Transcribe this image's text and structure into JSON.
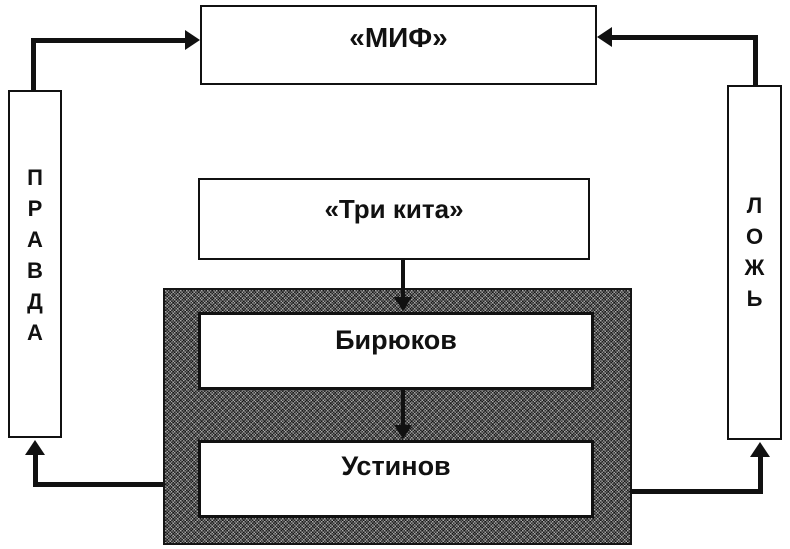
{
  "diagram": {
    "myth": {
      "label": "«МИФ»"
    },
    "three_whales": {
      "label": "«Три кита»"
    },
    "biryukov": {
      "label": "Бирюков"
    },
    "ustinov": {
      "label": "Устинов"
    },
    "truth": {
      "word": "ПРАВДА",
      "letters": [
        "П",
        "Р",
        "А",
        "В",
        "Д",
        "А"
      ]
    },
    "lie": {
      "word": "ЛОЖЬ",
      "letters": [
        "Л",
        "О",
        "Ж",
        "Ь"
      ]
    },
    "connections": [
      {
        "from": "truth",
        "to": "myth",
        "direction": "up-right"
      },
      {
        "from": "lie",
        "to": "myth",
        "direction": "up-left"
      },
      {
        "from": "three_whales",
        "to": "biryukov",
        "direction": "down"
      },
      {
        "from": "biryukov",
        "to": "ustinov",
        "direction": "down"
      },
      {
        "from": "gray-panel-left",
        "to": "truth",
        "direction": "left-up"
      },
      {
        "from": "gray-panel-right",
        "to": "lie",
        "direction": "right-up"
      }
    ]
  },
  "colors": {
    "background": "#ffffff",
    "line": "#111111",
    "box_border": "#111111",
    "box_fill": "#ffffff",
    "panel_texture_dark": "#404040",
    "panel_texture_light": "#8f8f8f"
  }
}
